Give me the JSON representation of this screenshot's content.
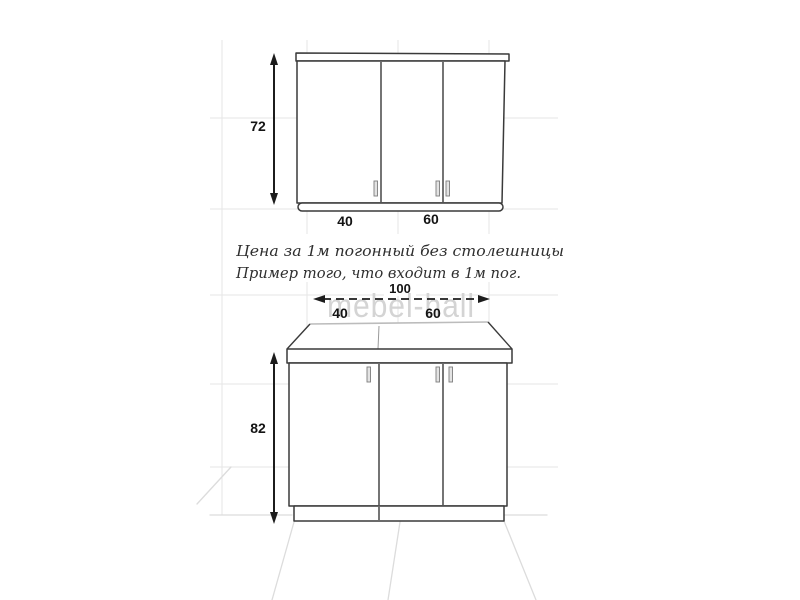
{
  "diagram": {
    "note_line1": "Цена за 1м погонный без столешницы",
    "note_line2": "Пример того, что входит в 1м пог.",
    "watermark": "mebel-hall",
    "wall_cabinet": {
      "height": "72",
      "door_widths": [
        "40",
        "60"
      ]
    },
    "base_cabinet": {
      "height": "82",
      "total_width": "100",
      "door_widths": [
        "40",
        "60"
      ]
    },
    "colors": {
      "line": "#3a3a3a",
      "grid": "#e5e5e5",
      "floor": "#dcdcdc",
      "watermark": "#d4d4d4"
    }
  }
}
